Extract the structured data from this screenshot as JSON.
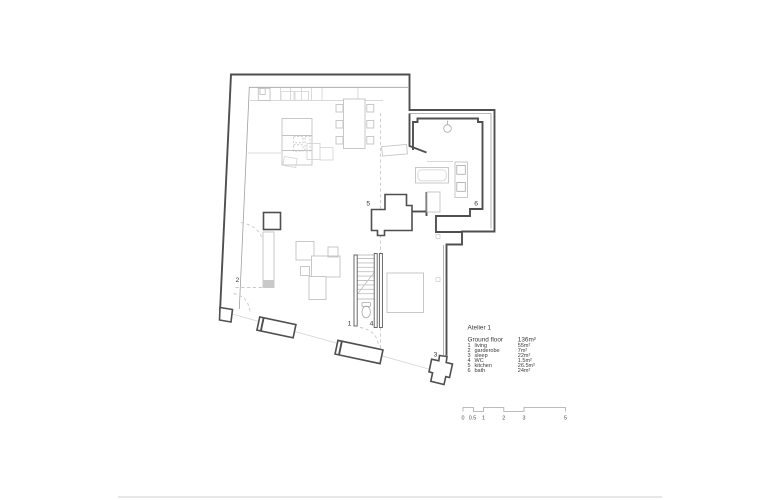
{
  "title_block": {
    "project": "Atelier 1",
    "floor": "Ground floor",
    "total_area": "136m²"
  },
  "legend": {
    "rooms": [
      {
        "num": "1",
        "name": "living",
        "area": "55m²"
      },
      {
        "num": "2",
        "name": "garderobe",
        "area": "7m²"
      },
      {
        "num": "3",
        "name": "sleep",
        "area": "22m²"
      },
      {
        "num": "4",
        "name": "WC",
        "area": "1.5m²"
      },
      {
        "num": "5",
        "name": "kitchen",
        "area": "26.5m²"
      },
      {
        "num": "6",
        "name": "bath",
        "area": "24m²"
      }
    ]
  },
  "plan": {
    "room_labels": [
      {
        "text": "1"
      },
      {
        "text": "2"
      },
      {
        "text": "3"
      },
      {
        "text": "4"
      },
      {
        "text": "5"
      },
      {
        "text": "6"
      }
    ]
  },
  "scale_bar": {
    "marks": [
      "0",
      "0.5",
      "1",
      "2",
      "3",
      "5"
    ]
  },
  "colors": {
    "wall": "#4f4f4f",
    "furniture": "#c2c2c2",
    "background": "#ffffff",
    "text": "#3a3a3a"
  }
}
